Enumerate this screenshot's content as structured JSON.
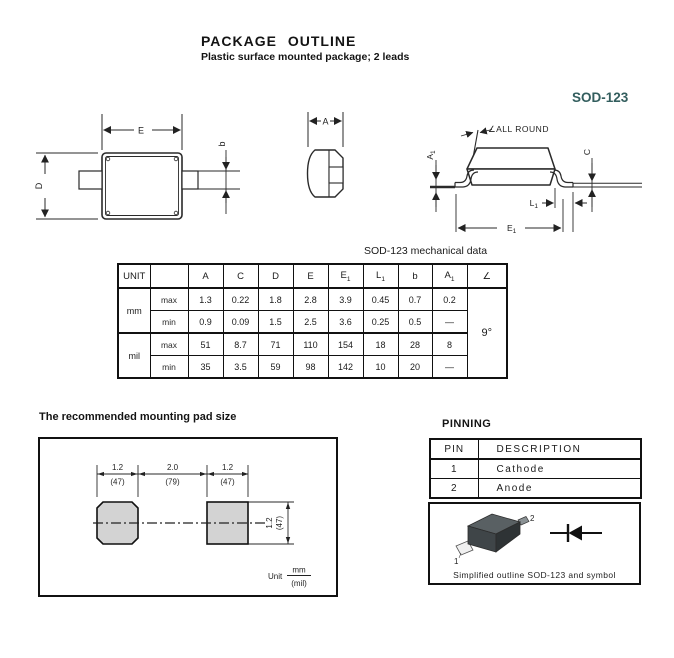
{
  "page": {
    "title": "PACKAGE OUTLINE",
    "subtitle": "Plastic surface mounted package; 2 leads",
    "package_name": "SOD-123",
    "accent_color": "#335e5e"
  },
  "drawings": {
    "top_view": {
      "dim_e": "E",
      "dim_d": "D",
      "dim_b": "b"
    },
    "end_view": {
      "dim_a": "A"
    },
    "side_view": {
      "all_round": "∠ALL ROUND",
      "a1b": "A",
      "a1s": "1",
      "c": "C",
      "l1b": "L",
      "l1s": "1",
      "e1b": "E",
      "e1s": "1"
    }
  },
  "mech_table": {
    "caption": "SOD-123 mechanical data",
    "headers": {
      "unit": "UNIT",
      "a": "A",
      "c": "C",
      "d": "D",
      "e": "E",
      "e1b": "E",
      "e1s": "1",
      "l1b": "L",
      "l1s": "1",
      "b": "b",
      "a1b": "A",
      "a1s": "1",
      "angle_sym": "∠"
    },
    "unit_mm": "mm",
    "unit_mil": "mil",
    "row_labels": [
      "max",
      "min",
      "max",
      "min"
    ],
    "rows": [
      [
        "1.3",
        "0.22",
        "1.8",
        "2.8",
        "3.9",
        "0.45",
        "0.7",
        "0.2"
      ],
      [
        "0.9",
        "0.09",
        "1.5",
        "2.5",
        "3.6",
        "0.25",
        "0.5",
        "—"
      ],
      [
        "51",
        "8.7",
        "71",
        "110",
        "154",
        "18",
        "28",
        "8"
      ],
      [
        "35",
        "3.5",
        "59",
        "98",
        "142",
        "10",
        "20",
        "—"
      ]
    ],
    "angle": "9°"
  },
  "pad_section": {
    "heading": "The recommended mounting pad size",
    "spans": [
      {
        "mm": "1.2",
        "mil": "(47)"
      },
      {
        "mm": "2.0",
        "mil": "(79)"
      },
      {
        "mm": "1.2",
        "mil": "(47)"
      }
    ],
    "vert": {
      "mm": "1.2",
      "mil": "(47)"
    },
    "unit": {
      "label": "Unit",
      "num": "mm",
      "den": "(mil)"
    }
  },
  "pinning": {
    "heading": "PINNING",
    "col_pin": "PIN",
    "col_desc": "DESCRIPTION",
    "rows": [
      {
        "pin": "1",
        "desc": "Cathode"
      },
      {
        "pin": "2",
        "desc": "Anode"
      }
    ]
  },
  "outline_box": {
    "caption": "Simplified outline SOD-123 and symbol",
    "pin1": "1",
    "pin2": "2"
  }
}
